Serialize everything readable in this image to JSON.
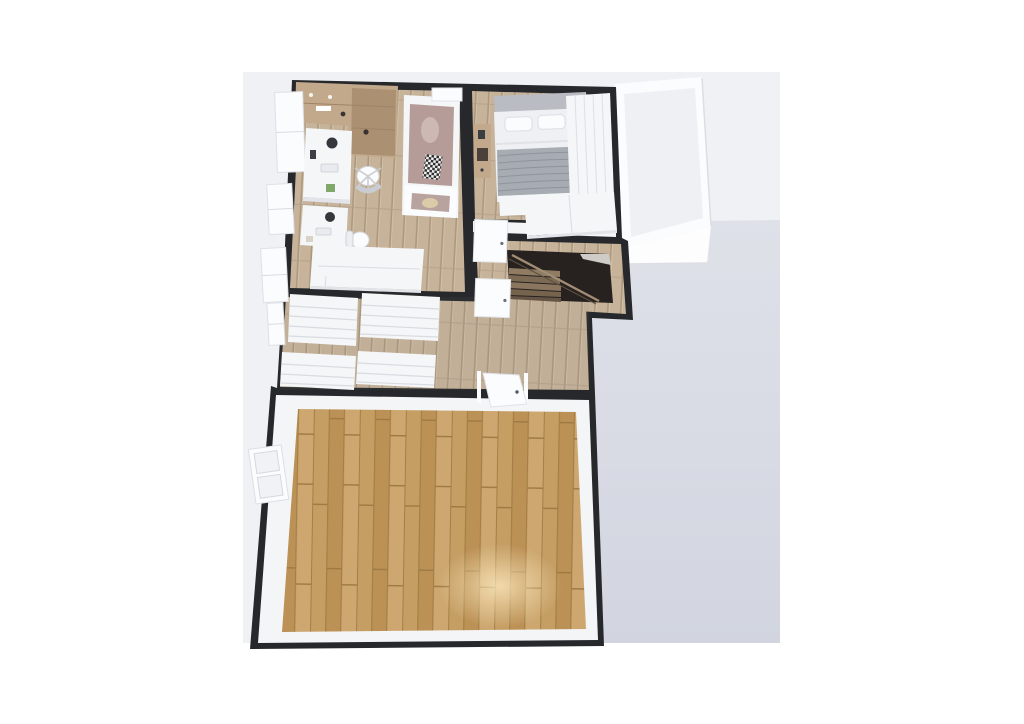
{
  "view": {
    "type": "floorplan-3d-render",
    "floor_shown": "upper floor",
    "background_split": "white page with light viewport panel and blue-gray ground plane"
  },
  "palette": {
    "page_bg": "#ffffff",
    "viewport_bg": "#f0f1f4",
    "ground": "#d7dae3",
    "wall": "#26282b",
    "wall_inner": "#f4f5f7",
    "furniture_white": "#f5f6f8",
    "wood_light": "#c6b39a",
    "wood_big_room": "#c39a62",
    "wood_tan": "#c3a98c",
    "accent_mauve": "#b59c98",
    "blanket_gray": "#a7abb2",
    "stair_dark": "#272220"
  },
  "scene": {
    "rooms": [
      {
        "name": "kids-bedroom-office",
        "position": "top-left",
        "furniture": [
          "tan-wardrobe-shelving",
          "desk-with-monitor",
          "desk-with-monitor-2",
          "office-chair",
          "office-chair-2",
          "single-bed-mauve-bedding",
          "checkered-throw",
          "foot-bench-with-hat",
          "white-craft-table",
          "wall-windows"
        ]
      },
      {
        "name": "master-bedroom",
        "position": "top-right",
        "furniture": [
          "double-bed-white-duvet",
          "gray-striped-blanket",
          "pillows",
          "wood-nightstand",
          "tall-wardrobe-right-wall",
          "low-dresser-row"
        ]
      },
      {
        "name": "balcony",
        "position": "right-of-bedroom",
        "furniture": []
      },
      {
        "name": "stair-hall",
        "position": "center",
        "furniture": [
          "staircase-down",
          "stair-railing",
          "white-door-a",
          "white-door-b"
        ]
      },
      {
        "name": "walk-in-closet",
        "position": "center-left",
        "furniture": [
          "shelving-unit-1",
          "shelving-unit-2",
          "shelving-unit-3",
          "shelving-unit-4",
          "small-window"
        ]
      },
      {
        "name": "empty-living-room",
        "position": "bottom",
        "furniture": [
          "plank-wood-floor",
          "double-window-left-wall",
          "white-door-c",
          "floor-light-spot"
        ]
      }
    ]
  }
}
